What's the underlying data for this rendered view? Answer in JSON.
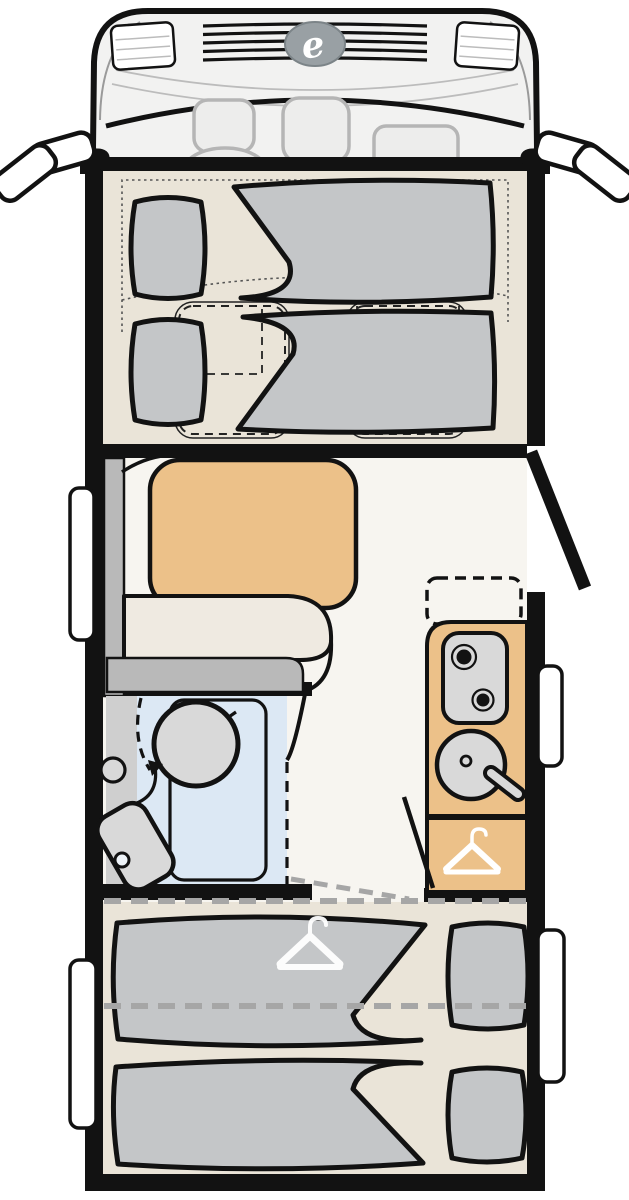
{
  "brand": {
    "logo_letter": "e"
  },
  "colors": {
    "ink": "#121212",
    "white": "#ffffff",
    "floor_beige": "#EAE4D8",
    "floor_light": "#F7F5F0",
    "furniture_gray": "#C4C6C8",
    "fixture_gray": "#D9D9D9",
    "backrest_gray": "#B9B9B9",
    "counter_tan": "#ECC189",
    "bath_blue": "#DCE8F4",
    "cab_body": "#F2F2F1",
    "cab_detail": "#B5B5B5",
    "dash_gray": "#A6A6A6"
  }
}
